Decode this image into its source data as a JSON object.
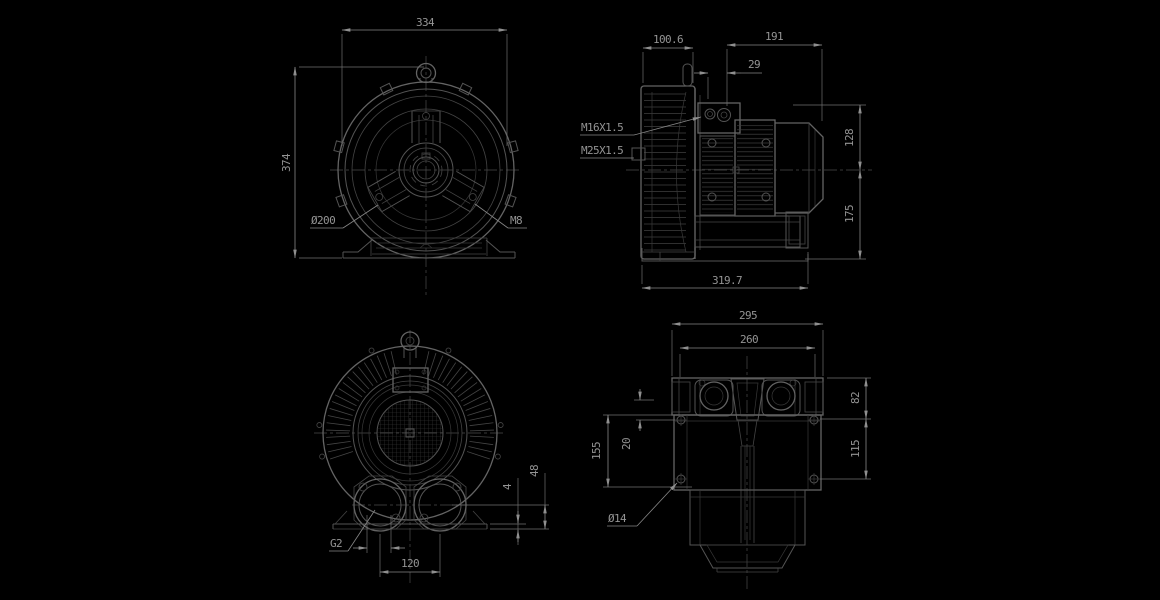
{
  "colors": {
    "background": "#000000",
    "object_line": "#5a5a5a",
    "dimension_line": "#8a8a8a",
    "text": "#949494"
  },
  "front_view": {
    "width": "334",
    "height": "374",
    "flange_diameter": "Ø200",
    "bolt_thread": "M8"
  },
  "side_view": {
    "fan_cover_depth": "100.6",
    "motor_length": "191",
    "gland_offset": "29",
    "height_above_axis": "128",
    "height_below_axis": "175",
    "total_length": "319.7",
    "cable_gland_small": "M16X1.5",
    "cable_gland_large": "M25X1.5"
  },
  "rear_view": {
    "port_thread": "G2",
    "port_spacing": "120",
    "foot_pad_height": "4",
    "port_center_height": "48"
  },
  "top_view": {
    "overall_width": "295",
    "clamp_spacing": "260",
    "hole_edge_offset": "82",
    "hole_spacing": "115",
    "foot_length": "155",
    "hole_inset": "20",
    "hole_diameter": "Ø14"
  }
}
